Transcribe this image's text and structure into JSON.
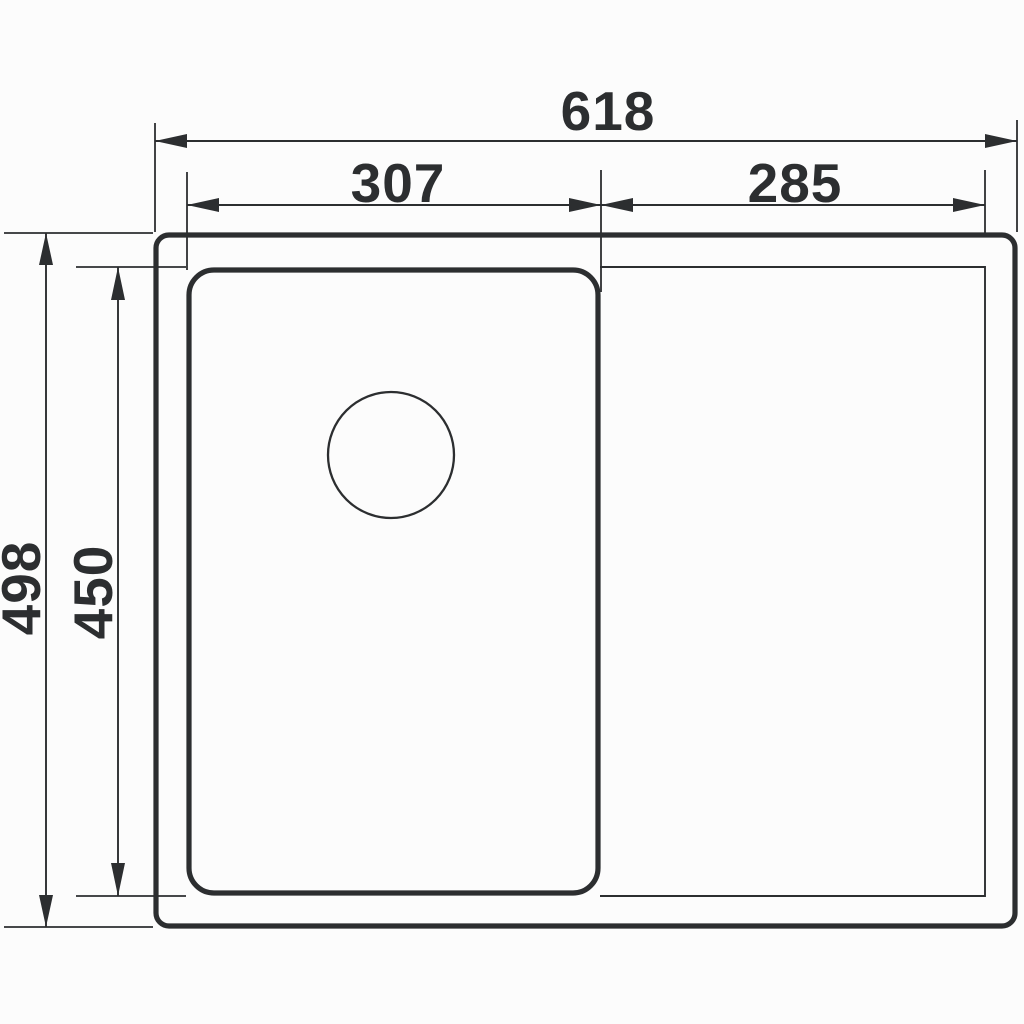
{
  "page": {
    "background": "#fcfcfc",
    "ink": "#2c2e30"
  },
  "drawing": {
    "kind": "sink-top-view-dimension-drawing",
    "dimensions": {
      "overall_width": "618",
      "bowl_width": "307",
      "drainer_width": "285",
      "overall_depth": "498",
      "bowl_depth": "450"
    }
  }
}
